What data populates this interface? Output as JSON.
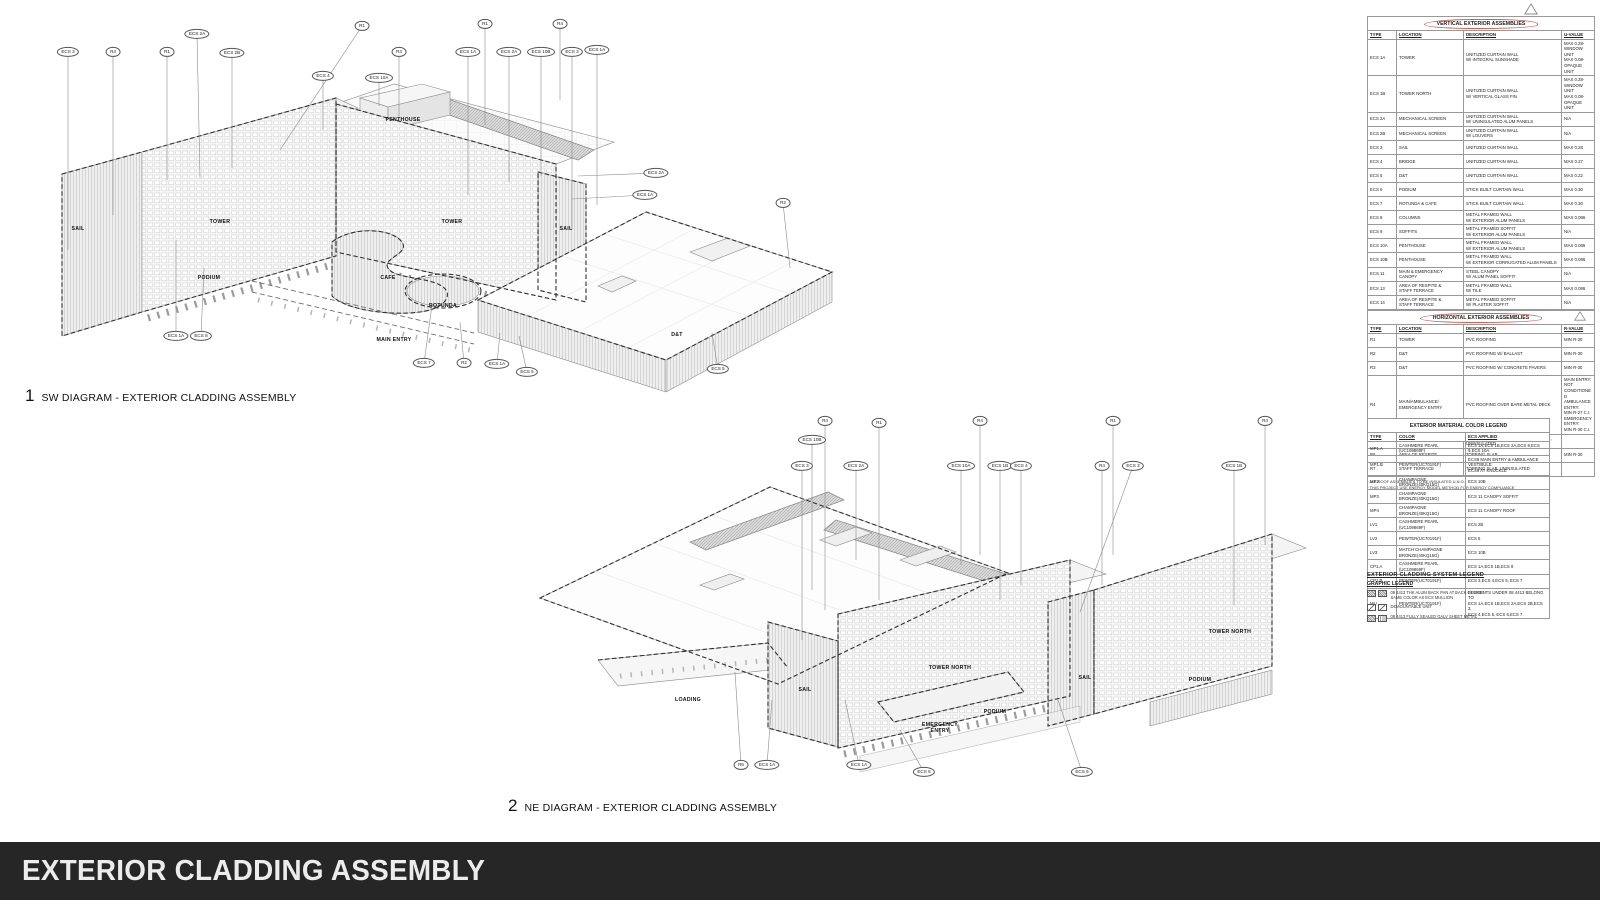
{
  "sheet": {
    "title": "EXTERIOR CLADDING ASSEMBLY"
  },
  "diagrams": {
    "sw": {
      "number": "1",
      "title": "SW DIAGRAM - EXTERIOR CLADDING ASSEMBLY",
      "labels": [
        {
          "t": "SAIL",
          "x": 78,
          "y": 229
        },
        {
          "t": "TOWER",
          "x": 220,
          "y": 222
        },
        {
          "t": "PODIUM",
          "x": 209,
          "y": 278
        },
        {
          "t": "PENTHOUSE",
          "x": 403,
          "y": 120
        },
        {
          "t": "TOWER",
          "x": 452,
          "y": 222
        },
        {
          "t": "SAIL",
          "x": 566,
          "y": 229
        },
        {
          "t": "CAFE",
          "x": 388,
          "y": 278
        },
        {
          "t": "ROTUNDA",
          "x": 443,
          "y": 306
        },
        {
          "t": "MAIN ENTRY",
          "x": 394,
          "y": 340
        },
        {
          "t": "D&T",
          "x": 677,
          "y": 335
        }
      ],
      "callouts": [
        {
          "t": "ECS 3",
          "x": 68,
          "y": 52,
          "ex": 68,
          "ey": 250
        },
        {
          "t": "R4",
          "x": 113,
          "y": 52,
          "ex": 113,
          "ey": 215
        },
        {
          "t": "R1",
          "x": 167,
          "y": 52,
          "ex": 167,
          "ey": 180
        },
        {
          "t": "ECS 2A",
          "x": 197,
          "y": 34,
          "ex": 200,
          "ey": 178
        },
        {
          "t": "ECS 2B",
          "x": 232,
          "y": 53,
          "ex": 232,
          "ey": 168
        },
        {
          "t": "R1",
          "x": 362,
          "y": 26,
          "ex": 280,
          "ey": 150
        },
        {
          "t": "R4",
          "x": 399,
          "y": 52,
          "ex": 399,
          "ey": 118
        },
        {
          "t": "ECS 4",
          "x": 323,
          "y": 76,
          "ex": 323,
          "ey": 130
        },
        {
          "t": "ECS 10A",
          "x": 379,
          "y": 78,
          "ex": 379,
          "ey": 106
        },
        {
          "t": "R1",
          "x": 485,
          "y": 24,
          "ex": 485,
          "ey": 125
        },
        {
          "t": "R4",
          "x": 560,
          "y": 24,
          "ex": 560,
          "ey": 100
        },
        {
          "t": "ECS 1A",
          "x": 468,
          "y": 52,
          "ex": 468,
          "ey": 195
        },
        {
          "t": "ECS 2A",
          "x": 509,
          "y": 52,
          "ex": 509,
          "ey": 182
        },
        {
          "t": "ECS 10B",
          "x": 541,
          "y": 52,
          "ex": 541,
          "ey": 176
        },
        {
          "t": "ECS 3",
          "x": 572,
          "y": 52,
          "ex": 572,
          "ey": 230
        },
        {
          "t": "ECS 1A",
          "x": 597,
          "y": 50,
          "ex": 597,
          "ey": 205
        },
        {
          "t": "ECS 2A",
          "x": 656,
          "y": 173,
          "ex": 578,
          "ey": 176
        },
        {
          "t": "ECS 1A",
          "x": 645,
          "y": 195,
          "ex": 572,
          "ey": 199
        },
        {
          "t": "R2",
          "x": 783,
          "y": 203,
          "ex": 790,
          "ey": 268
        },
        {
          "t": "ECS 1A",
          "x": 176,
          "y": 336,
          "ex": 176,
          "ey": 240
        },
        {
          "t": "ECS 8",
          "x": 201,
          "y": 336,
          "ex": 204,
          "ey": 268
        },
        {
          "t": "ECS 7",
          "x": 424,
          "y": 363,
          "ex": 432,
          "ey": 305
        },
        {
          "t": "R2",
          "x": 464,
          "y": 363,
          "ex": 460,
          "ey": 322
        },
        {
          "t": "ECS 1A",
          "x": 497,
          "y": 364,
          "ex": 500,
          "ey": 333
        },
        {
          "t": "ECS 5",
          "x": 527,
          "y": 372,
          "ex": 519,
          "ey": 336
        },
        {
          "t": "ECS 5",
          "x": 718,
          "y": 369,
          "ex": 712,
          "ey": 333
        }
      ]
    },
    "ne": {
      "number": "2",
      "title": "NE DIAGRAM - EXTERIOR CLADDING ASSEMBLY",
      "labels": [
        {
          "t": "LOADING",
          "x": 688,
          "y": 700
        },
        {
          "t": "SAIL",
          "x": 805,
          "y": 690
        },
        {
          "t": "TOWER NORTH",
          "x": 950,
          "y": 668
        },
        {
          "t": "EMERGENCY\nENTRY",
          "x": 940,
          "y": 728
        },
        {
          "t": "PODIUM",
          "x": 995,
          "y": 712
        },
        {
          "t": "SAIL",
          "x": 1085,
          "y": 678
        },
        {
          "t": "TOWER NORTH",
          "x": 1230,
          "y": 632
        },
        {
          "t": "PODIUM",
          "x": 1200,
          "y": 680
        }
      ],
      "callouts": [
        {
          "t": "R4",
          "x": 825,
          "y": 421,
          "ex": 825,
          "ey": 610
        },
        {
          "t": "ECS 10B",
          "x": 812,
          "y": 440,
          "ex": 812,
          "ey": 590
        },
        {
          "t": "ECS 3",
          "x": 802,
          "y": 466,
          "ex": 802,
          "ey": 640
        },
        {
          "t": "ECS 2A",
          "x": 856,
          "y": 466,
          "ex": 856,
          "ey": 560
        },
        {
          "t": "R1",
          "x": 879,
          "y": 423,
          "ex": 879,
          "ey": 600
        },
        {
          "t": "ECS 10A",
          "x": 961,
          "y": 466,
          "ex": 961,
          "ey": 565
        },
        {
          "t": "R4",
          "x": 980,
          "y": 421,
          "ex": 980,
          "ey": 555
        },
        {
          "t": "ECS 1B",
          "x": 1000,
          "y": 466,
          "ex": 1000,
          "ey": 600
        },
        {
          "t": "ECS 4",
          "x": 1021,
          "y": 466,
          "ex": 1021,
          "ey": 585
        },
        {
          "t": "R1",
          "x": 1113,
          "y": 421,
          "ex": 1113,
          "ey": 555
        },
        {
          "t": "R4",
          "x": 1102,
          "y": 466,
          "ex": 1102,
          "ey": 585
        },
        {
          "t": "ECS 3",
          "x": 1133,
          "y": 466,
          "ex": 1080,
          "ey": 612
        },
        {
          "t": "ECS 1B",
          "x": 1234,
          "y": 466,
          "ex": 1234,
          "ey": 605
        },
        {
          "t": "R4",
          "x": 1265,
          "y": 421,
          "ex": 1265,
          "ey": 545
        },
        {
          "t": "R5",
          "x": 741,
          "y": 765,
          "ex": 735,
          "ey": 672
        },
        {
          "t": "ECS 1A",
          "x": 767,
          "y": 765,
          "ex": 772,
          "ey": 700
        },
        {
          "t": "ECS 1A",
          "x": 859,
          "y": 765,
          "ex": 845,
          "ey": 700
        },
        {
          "t": "ECS 6",
          "x": 924,
          "y": 772,
          "ex": 900,
          "ey": 730
        },
        {
          "t": "ECS 6",
          "x": 1082,
          "y": 772,
          "ex": 1058,
          "ey": 700
        }
      ]
    }
  },
  "panel": {
    "vertical": {
      "title": "VERTICAL EXTERIOR ASSEMBLIES",
      "columns": [
        "TYPE",
        "LOCATION",
        "DESCRIPTION",
        "U-VALUE"
      ],
      "rows": [
        [
          "ECS 1A",
          "TOWER",
          "UNITIZED CURTAIN WALL\nW/ INTEGRAL SUNSHADE",
          "MAX 0.28-WINDOW UNIT\nMAX 0.08-OPAQUE UNIT"
        ],
        [
          "ECS 1B",
          "TOWER NORTH",
          "UNITIZED CURTAIN WALL\nW/ VERTICAL GLASS FIN",
          "MAX 0.28-WINDOW UNIT\nMAX 0.08-OPAQUE UNIT"
        ],
        [
          "ECS 2A",
          "MECHANICAL SCREEN",
          "UNITIZED CURTAIN WALL\nW/ UNINSULATED ALUM PANELS",
          "N/A"
        ],
        [
          "ECS 2B",
          "MECHANICAL SCREEN",
          "UNITIZED CURTAIN WALL\nW/ LOUVERS",
          "N/A"
        ],
        [
          "ECS 3",
          "SAIL",
          "UNITIZED CURTAIN WALL",
          "MAX 0.28"
        ],
        [
          "ECS 4",
          "BRIDGE",
          "UNITIZED CURTAIN WALL",
          "MAX 0.27"
        ],
        [
          "ECS 5",
          "D&T",
          "UNITIZED CURTAIN WALL",
          "MAX 0.22"
        ],
        [
          "ECS 6",
          "PODIUM",
          "STICK BUILT CURTAIN WALL",
          "MAX 0.30"
        ],
        [
          "ECS 7",
          "ROTUNDA & CAFE",
          "STICK BUILT CURTAIN WALL",
          "MAX 0.30"
        ],
        [
          "ECS 8",
          "COLUMNS",
          "METAL FRAMED WALL\nW/ EXTERIOR ALUM PANELS",
          "MAX 0.086"
        ],
        [
          "ECS 9",
          "SOFFITS",
          "METAL FRAMED SOFFIT\nW/ EXTERIOR ALUM PANELS",
          "N/A"
        ],
        [
          "ECS 10A",
          "PENTHOUSE",
          "METAL FRAMED WALL\nW/ EXTERIOR ALUM PANELS",
          "MAX 0.086"
        ],
        [
          "ECS 10B",
          "PENTHOUSE",
          "METAL FRAMED WALL\nW/ EXTERIOR CORRUGATED ALUM PANELS",
          "MAX 0.086"
        ],
        [
          "ECS 11",
          "MAIN & EMERGENCY\nCANOPY",
          "STEEL CANOPY\nW/ ALUM PANEL SOFFIT",
          "N/A"
        ],
        [
          "ECS 13",
          "AREA OF RESPITE &\nSTAFF TERRACE",
          "METAL FRAMED WALL\nW/ TILE",
          "MAX 0.086"
        ],
        [
          "ECS 14",
          "AREA OF RESPITE &\nSTAFF TERRACE",
          "METAL FRAMED SOFFIT\nW/ PLASTER SOFFIT",
          "N/A"
        ]
      ]
    },
    "horizontal": {
      "title": "HORIZONTAL EXTERIOR ASSEMBLIES",
      "columns": [
        "TYPE",
        "LOCATION",
        "DESCRIPTION",
        "R-VALUE"
      ],
      "rows": [
        [
          "R1",
          "TOWER",
          "PVC ROOFING",
          "MIN R-30"
        ],
        [
          "R2",
          "D&T",
          "PVC ROOFING W/ BALLAST",
          "MIN R-30"
        ],
        [
          "R3",
          "D&T",
          "PVC ROOFING W/ CONCRETE PAVERS",
          "MIN R-30"
        ],
        [
          "R4",
          "MAIN/AMBULANCE/\nEMERGENCY ENTRY",
          "PVC ROOFING OVER BARE METAL DECK",
          "MAIN ENTRY:\nNOT CONDITIONED\nAMBULANCE ENTRY:\nMIN R-27 C.I.\nEMERGENCY ENTRY:\nMIN R-30 C.I."
        ],
        [
          "R5",
          "LOADING",
          "PVC ROOFING OVER BARE METAL DECK,\nUNINSULATED",
          ""
        ],
        [
          "R6",
          "AREA OF RESPITE",
          "TOPPING SLAB",
          "MIN R-30"
        ],
        [
          "R7",
          "STAFF TERRACE",
          "TOPPING SLAB, UNINSULATED",
          ""
        ]
      ],
      "footnotes": [
        "* ALL ROOF ASSEMBLIES TO BE INSULATED U.N.O.",
        "* THIS PROJECT USE ENERGY MODEL METHOD FOR ENERGY COMPLIANCE"
      ]
    },
    "color_legend": {
      "title": "EXTERIOR MATERIAL COLOR LEGEND",
      "columns": [
        "TYPE",
        "COLOR",
        "ECS APPLIED"
      ],
      "rows": [
        [
          "MP1.A",
          "CASHMERE PEARL\n(UC109869F)",
          "ECS 1A,ECS 1B,ECS 2A,ECS 8,ECS 9,ECS 10A"
        ],
        [
          "MP1.B",
          "PEWTER(UC70191F)",
          "ECS8 MAIN ENTRY & AMBULANCE VESTIBULE\nECS9 AT KNUCKLE"
        ],
        [
          "MP2",
          "CHAMPAGNE\nBRONZE(40KQ15G)",
          "ECS 10B"
        ],
        [
          "MP3",
          "CHAMPAGNE\nBRONZE(40KQ15G)",
          "ECS 11 CANOPY SOFFIT"
        ],
        [
          "MP4",
          "CHAMPAGNE\nBRONZE(40KQ15G)",
          "ECS 11 CANOPY ROOF"
        ],
        [
          "LV1",
          "CASHMERE PEARL\n(UC109869F)",
          "ECS 2B"
        ],
        [
          "LV2",
          "PEWTER(UC70191F)",
          "ECS 5"
        ],
        [
          "LV3",
          "MATCH CHAMPAGNE\nBRONZE(40KQ15G)",
          "ECS 10B"
        ],
        [
          "CP1.A",
          "CASHMERE PEARL\n(UC109869F)",
          "ECS 1A,ECS 1B,ECS 8"
        ],
        [
          "CP1.B",
          "PEWTER(UC70191F)",
          "ECS 3,ECS 4,ECS 5, ECS 7"
        ],
        [
          "MU",
          "PEWTER(UC70191F)",
          "ELEMENTS UNDER 08 4413 BELONG TO\nECS 1A,ECS 1B,ECS 2A,ECS 2B,ECS 3,\nECS 4,ECS 5, ECS 6,ECS 7"
        ]
      ]
    },
    "system_legend": {
      "title": "EXTERIOR CLADDING SYSTEM LEGEND",
      "subtitle": "GRAPHIC LEGEND",
      "items": [
        {
          "symbol": "alum-back-pan-hatch-symbol",
          "label": "08 4413 THK ALUM BACK PAN AT BACK OF ECS.\nSAME COLOR AS ECS MULLION"
        },
        {
          "symbol": "demountable-unit-symbol",
          "label": "DEMOUNTABLE UNIT"
        },
        {
          "symbol": "galv-sheet-metal-symbol",
          "label": "08 4413 FULLY SEALED GALV SHEET METAL"
        }
      ]
    }
  },
  "colors": {
    "bar_bg": "#262626",
    "bar_text": "#ececec",
    "cloud": "#c4655a",
    "line": "#8a8a8a"
  }
}
